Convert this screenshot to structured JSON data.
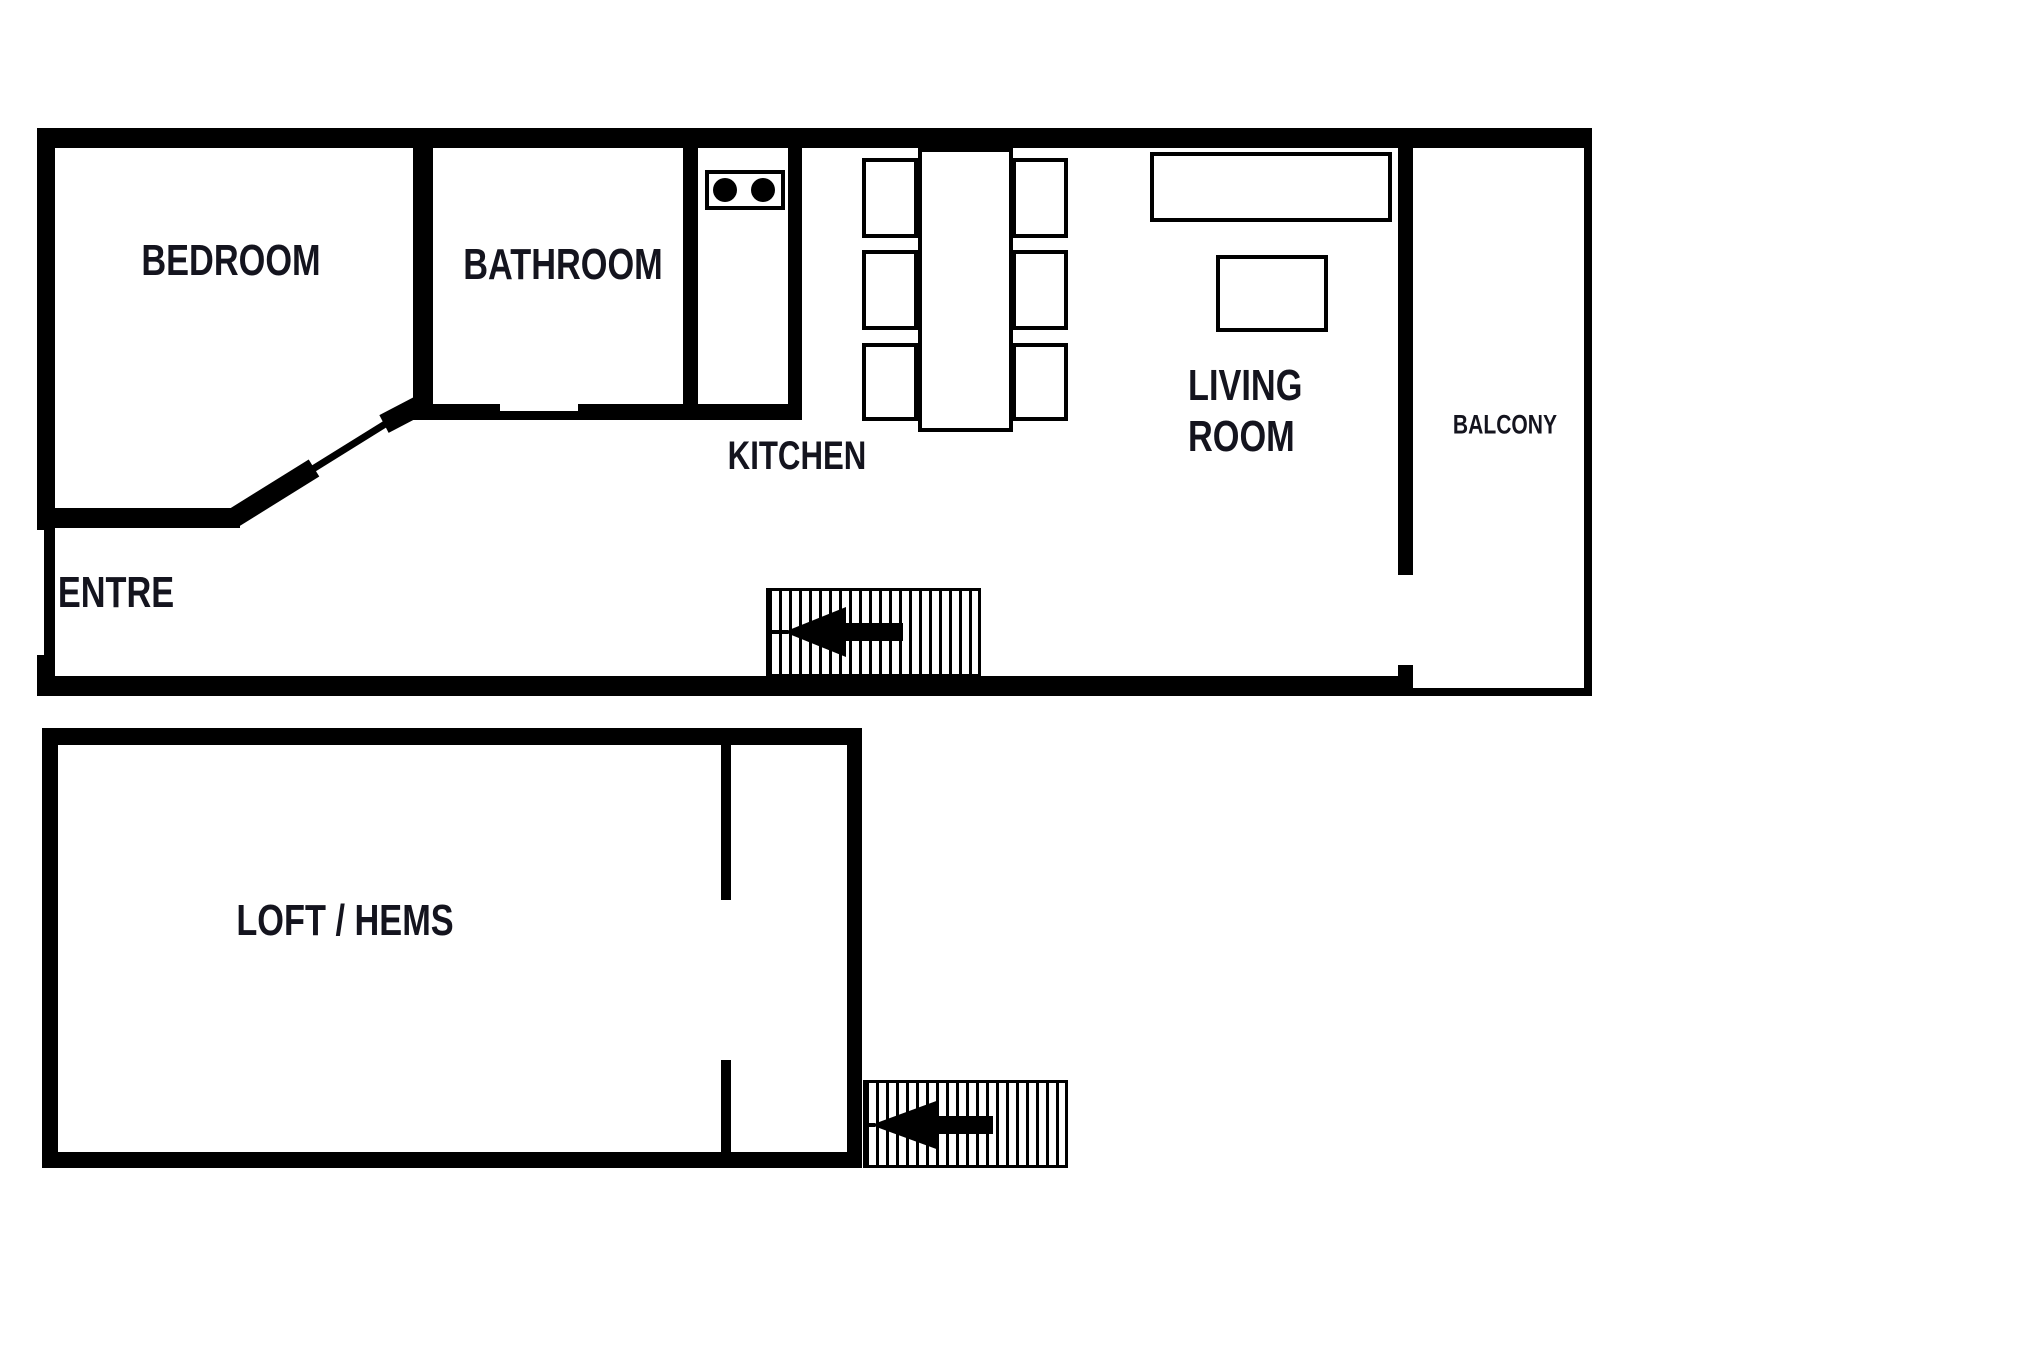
{
  "document": {
    "type": "floor-plan",
    "background": "#ffffff"
  },
  "colors": {
    "wall": "#000000",
    "label": "#14141e",
    "floor": "#ffffff"
  },
  "labels": {
    "bedroom": "BEDROOM",
    "bathroom": "BATHROOM",
    "kitchen": "KITCHEN",
    "living_line1": "LIVING",
    "living_line2": "ROOM",
    "balcony": "BALCONY",
    "entre": "ENTRE",
    "loft": "LOFT / HEMS"
  },
  "icons": {
    "stove": "stove-two-burner-icon",
    "upper_stairs": "staircase-arrow-left-icon",
    "lower_stairs": "staircase-arrow-left-icon",
    "dining_set": "table-with-six-chairs",
    "sofa": "sofa",
    "coffee_table": "coffee-table"
  }
}
